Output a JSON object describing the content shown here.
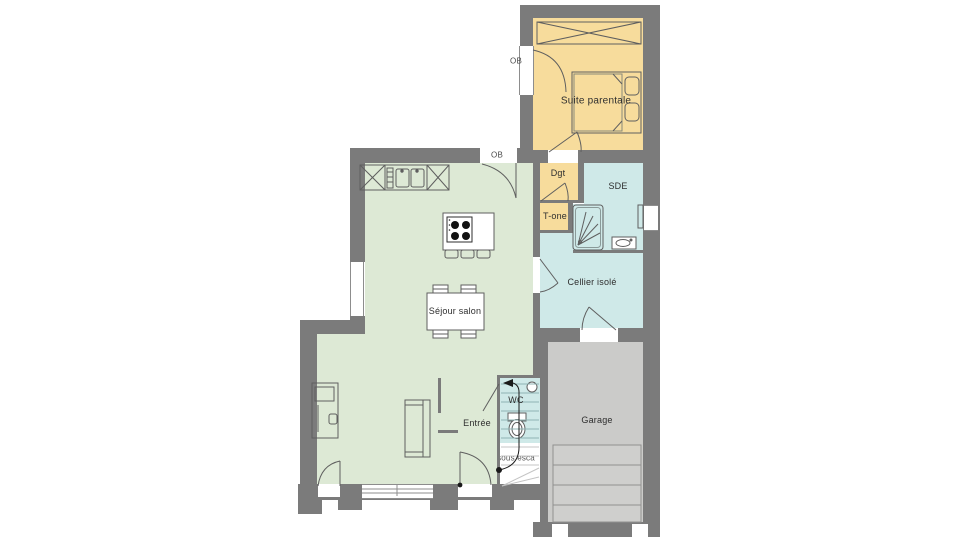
{
  "plan": {
    "type": "floor-plan",
    "labels": {
      "suite_parentale": "Suite parentale",
      "ob_window": "OB",
      "ob_door": "OB",
      "dgt": "Dgt",
      "t_one": "T-one",
      "sde": "SDE",
      "cellier": "Cellier isolé",
      "sejour_salon": "Séjour salon",
      "entree": "Entrée",
      "wc": "WC",
      "sous_escalier": "sous esca",
      "garage": "Garage"
    },
    "colors": {
      "wall": "#7b7b7b",
      "room_orange": "#f7dc9c",
      "room_green": "#dde9d5",
      "room_blue": "#cfe9e8",
      "garage_floor": "#cbcbc9",
      "linework": "#5f5f5f"
    }
  }
}
